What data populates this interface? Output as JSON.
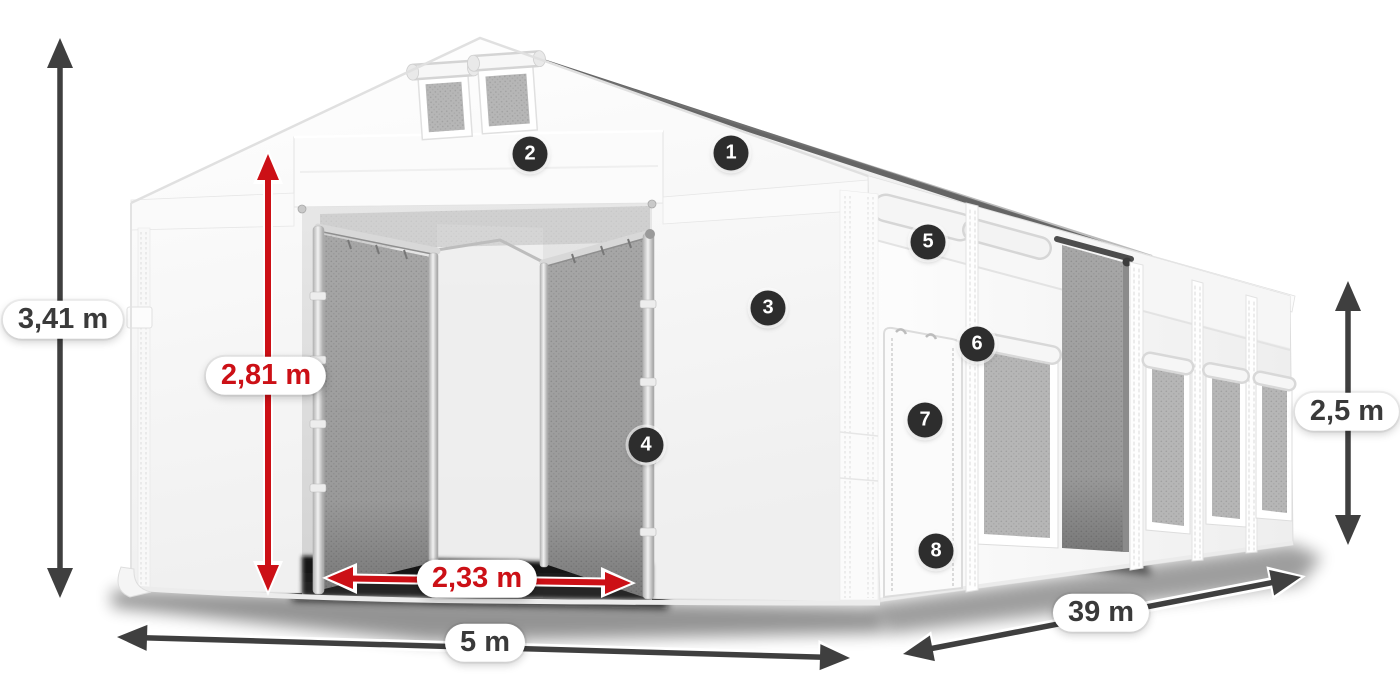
{
  "figure": {
    "title": "Storage tent dimension diagram",
    "colors": {
      "accent-red": "#cc1016",
      "arrow-dark": "#3f3f3f",
      "badge-bg": "#2d2d2d",
      "badge-text": "#ffffff",
      "label-text": "#3a3a3a",
      "label-bg": "#ffffff"
    },
    "dimensions": [
      {
        "id": "total-height",
        "label": "3,41 m",
        "style": "dark",
        "orientation": "vertical"
      },
      {
        "id": "entrance-height",
        "label": "2,81 m",
        "style": "red",
        "orientation": "vertical"
      },
      {
        "id": "entrance-width",
        "label": "2,33 m",
        "style": "red",
        "orientation": "horizontal"
      },
      {
        "id": "width",
        "label": "5 m",
        "style": "dark",
        "orientation": "horizontal"
      },
      {
        "id": "length",
        "label": "39 m",
        "style": "dark",
        "orientation": "diagonal"
      },
      {
        "id": "side-height",
        "label": "2,5 m",
        "style": "dark",
        "orientation": "vertical"
      }
    ],
    "callouts": [
      {
        "number": "1"
      },
      {
        "number": "2"
      },
      {
        "number": "3"
      },
      {
        "number": "4"
      },
      {
        "number": "5"
      },
      {
        "number": "6"
      },
      {
        "number": "7"
      },
      {
        "number": "8"
      }
    ]
  }
}
